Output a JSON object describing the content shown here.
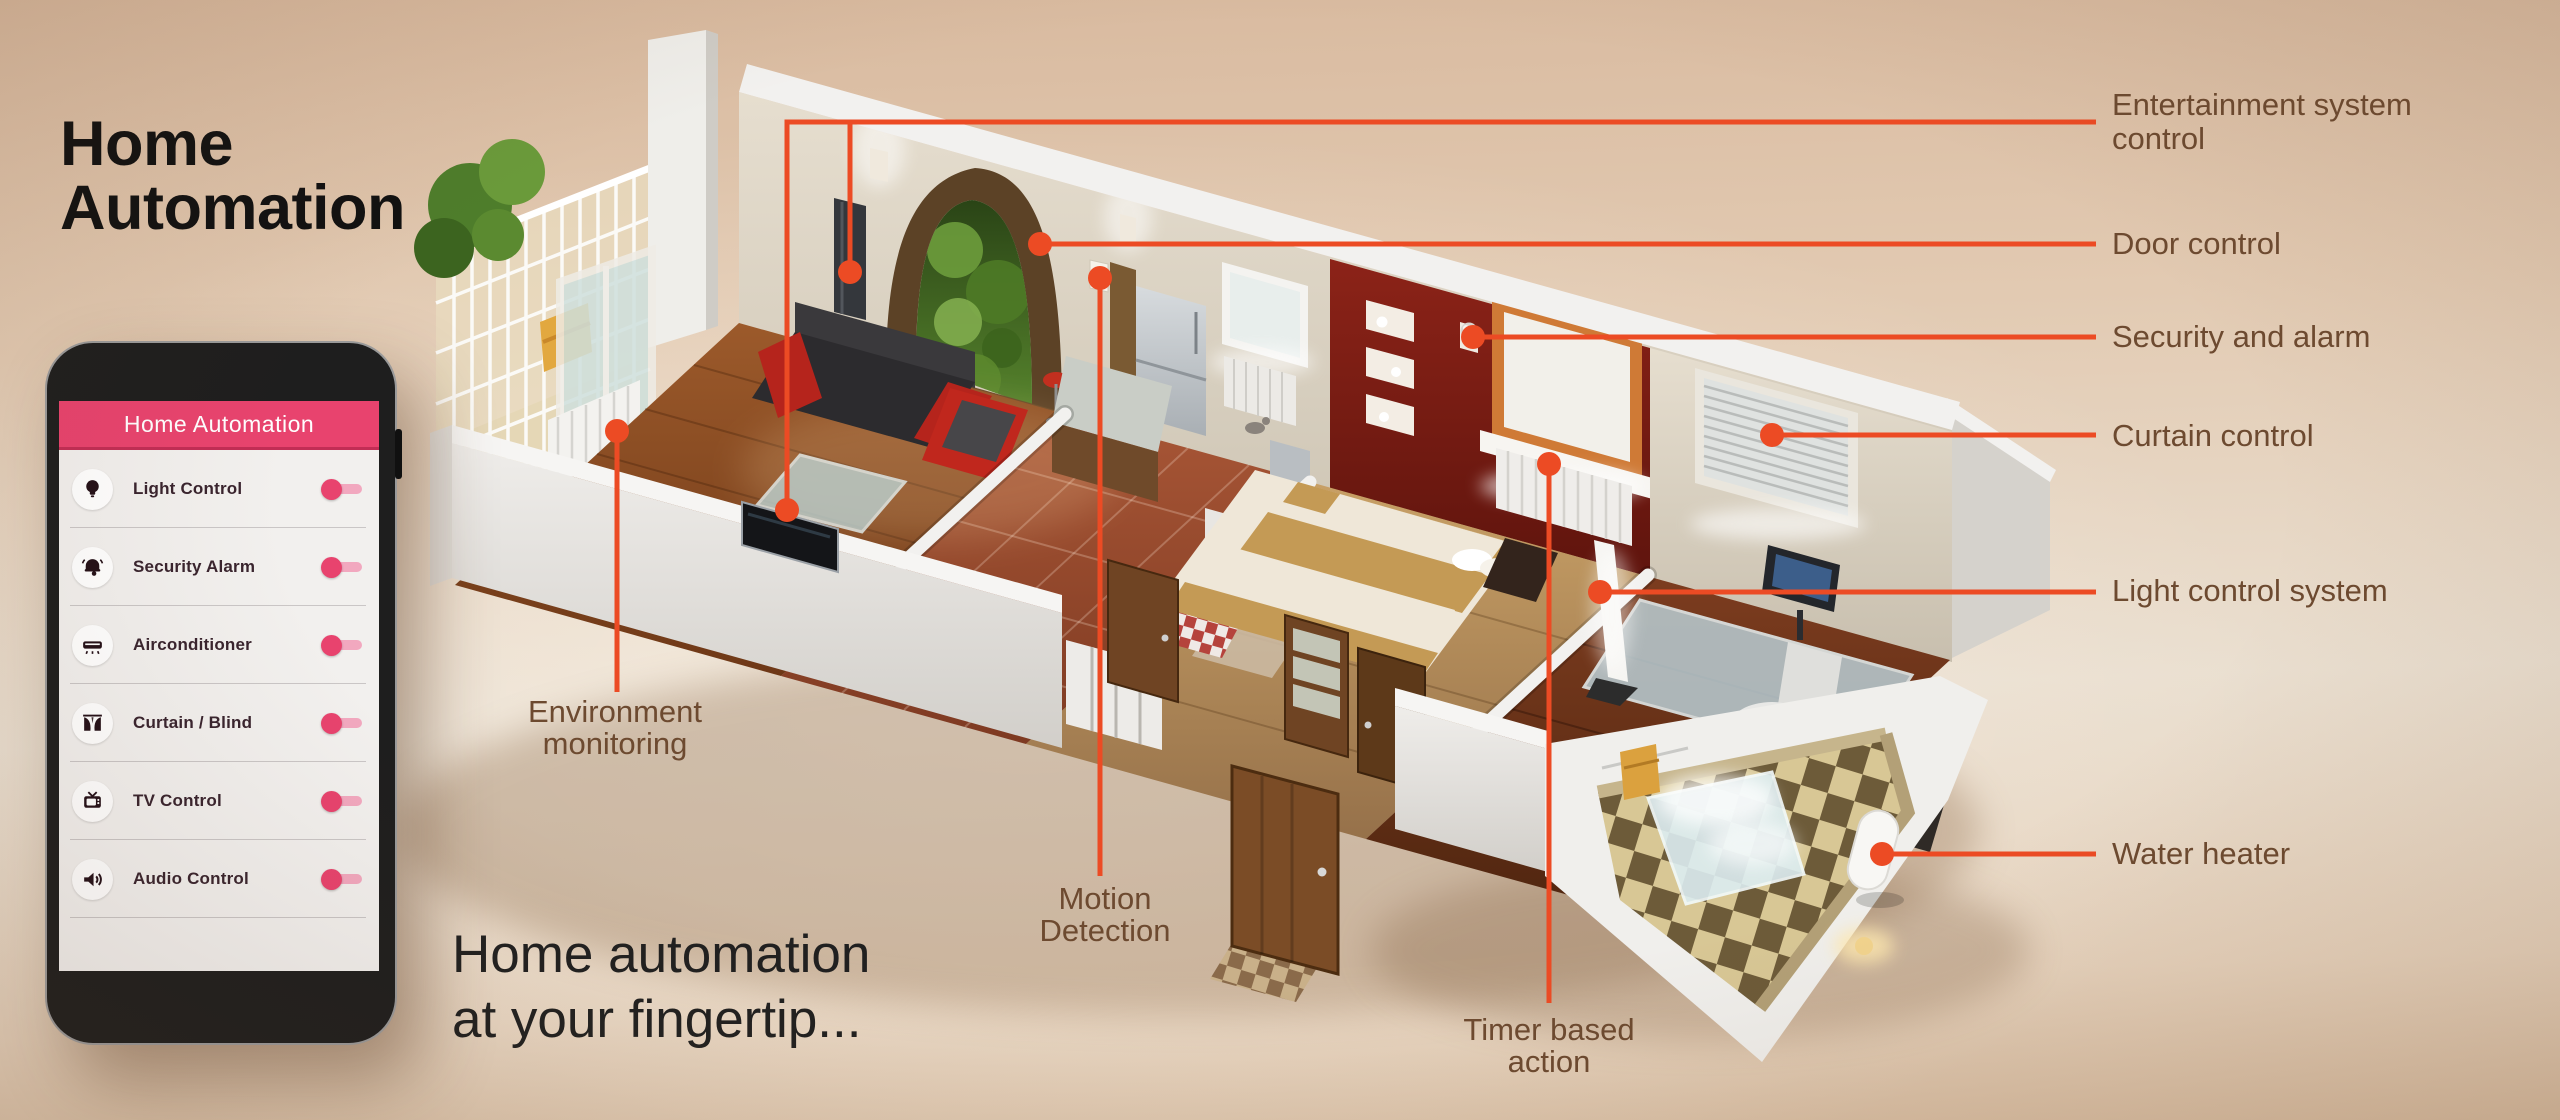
{
  "title": {
    "line1": "Home",
    "line2": "Automation"
  },
  "tagline": {
    "line1": "Home automation",
    "line2": "at your fingertip..."
  },
  "phone": {
    "header": "Home Automation",
    "items": [
      {
        "label": "Light Control",
        "icon": "light-bulb",
        "state": "on"
      },
      {
        "label": "Security Alarm",
        "icon": "alarm-bell",
        "state": "on"
      },
      {
        "label": "Airconditioner",
        "icon": "air-conditioner",
        "state": "on"
      },
      {
        "label": "Curtain / Blind",
        "icon": "curtain",
        "state": "on"
      },
      {
        "label": "TV Control",
        "icon": "tv",
        "state": "on"
      },
      {
        "label": "Audio  Control",
        "icon": "speaker",
        "state": "on"
      }
    ]
  },
  "callouts": {
    "right": [
      {
        "id": "entertainment",
        "line1": "Entertainment system",
        "line2": "control"
      },
      {
        "id": "door",
        "line1": "Door control",
        "line2": ""
      },
      {
        "id": "security",
        "line1": "Security and alarm",
        "line2": ""
      },
      {
        "id": "curtain",
        "line1": "Curtain control",
        "line2": ""
      },
      {
        "id": "light",
        "line1": "Light control system",
        "line2": ""
      },
      {
        "id": "water-heater",
        "line1": "Water heater",
        "line2": ""
      }
    ],
    "floor": [
      {
        "id": "environment",
        "line1": "Environment",
        "line2": "monitoring"
      },
      {
        "id": "motion",
        "line1": "Motion",
        "line2": "Detection"
      },
      {
        "id": "timer",
        "line1": "Timer based",
        "line2": "action"
      }
    ]
  },
  "colors": {
    "accent_orange": "#EC4B24",
    "brand_pink": "#E8436E",
    "toggle_track_pink": "#F2A8BF",
    "label_brown": "#6D4A30",
    "headline_black": "#111111"
  }
}
